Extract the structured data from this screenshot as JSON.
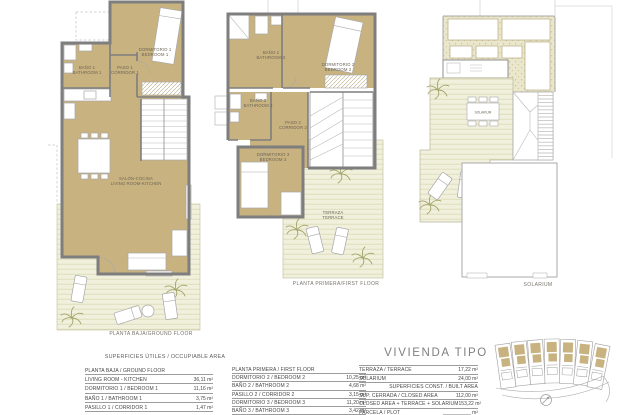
{
  "colors": {
    "room_tan": "#c8b280",
    "wall_gray": "#7e7e7e",
    "deck_cream": "#f1f0dd",
    "gravel_beige": "#ebe7cc",
    "table_line_gray": "#9c9c9c"
  },
  "plans": {
    "ground": {
      "caption": "PLANTA BAJA/GROUND FLOOR",
      "rooms": {
        "bedroom1": {
          "es": "DORMITORIO 1",
          "en": "BEDROOM 1"
        },
        "bath1": {
          "es": "BAÑO 1",
          "en": "BATHROOM 1"
        },
        "corridor1": {
          "es": "PASO 1",
          "en": "CORRIDOR 1"
        },
        "living": {
          "es": "SALÓN-COCINA",
          "en": "LIVING ROOM-KITCHEN"
        }
      }
    },
    "first": {
      "caption": "PLANTA PRIMERA/FIRST FLOOR",
      "rooms": {
        "bath2": {
          "es": "BAÑO 2",
          "en": "BATHROOM 2"
        },
        "bedroom2": {
          "es": "DORMITORIO 2",
          "en": "BEDROOM 2"
        },
        "bath3": {
          "es": "BAÑO 3",
          "en": "BATHROOM 3"
        },
        "corridor2": {
          "es": "PASO 2",
          "en": "CORRIDOR 2"
        },
        "bedroom3": {
          "es": "DORMITORIO 3",
          "en": "BEDROOM 3"
        },
        "terrace": {
          "es": "TERRAZA",
          "en": "TERRACE"
        }
      }
    },
    "solarium": {
      "caption": "SOLARIUM",
      "rooms": {
        "solarium": {
          "es": "SOLARIUM"
        }
      }
    }
  },
  "tables": {
    "title": "SUPERFICIES ÚTILES / OCCUPIABLE AREA",
    "ground": {
      "header": "PLANTA BAJA / GROUND FLOOR",
      "rows": [
        {
          "label": "LIVING ROOM - KITCHEN",
          "value": "36,11 m²"
        },
        {
          "label": "DORMITORIO 1 /  BEDROOM 1",
          "value": "11,16 m²"
        },
        {
          "label": "BAÑO 1 / BATHROOM 1",
          "value": "3,75 m²"
        },
        {
          "label": "PASILLO 1 / CORRIDOR 1",
          "value": "1,47 m²"
        }
      ]
    },
    "first": {
      "header": "PLANTA PRIMERA / FIRST FLOOR",
      "rows": [
        {
          "label": "DORMITORIO 2 / BEDROOM 2",
          "value": "10,25 m²"
        },
        {
          "label": "BAÑO 2 / BATHROOM 2",
          "value": "4,68 m²"
        },
        {
          "label": "PASILLO 2 / CORRIDOR 2",
          "value": "3,15 m²"
        },
        {
          "label": "DORMITORIO 3 / BEDROOM 3",
          "value": "11,20 m²"
        },
        {
          "label": "BAÑO 3 / BATHROOM 3",
          "value": "3,42 m²"
        }
      ]
    },
    "vivienda": {
      "heading": "VIVIENDA TIPO",
      "rows": [
        {
          "label": "TERRAZA / TERRACE",
          "value": "17,22 m²"
        },
        {
          "label": "SOLARIUM",
          "value": "24,00 m²"
        },
        {
          "label": "SUPERFICIES CONST. / BUILT AREA",
          "value": ""
        },
        {
          "label": "SUP. CERRADA / CLOSED AREA",
          "value": "112,00 m²"
        },
        {
          "label": "CLOSED AREA + TERRACE + SOLARIUM",
          "value": "153,22 m²"
        },
        {
          "label": "PARCELA / PLOT",
          "value": "__________ m²"
        }
      ]
    }
  }
}
